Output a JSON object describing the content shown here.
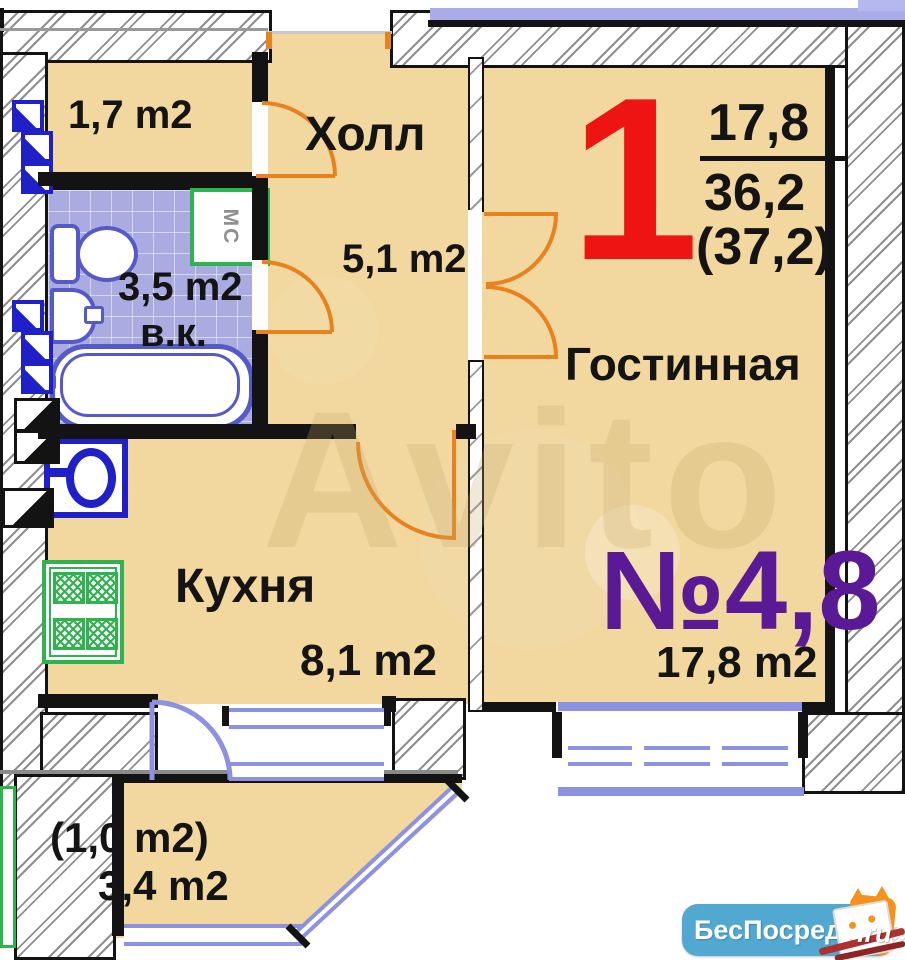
{
  "labels": {
    "closet_area": "1,7 m2",
    "hall_name": "Холл",
    "hall_area": "5,1 m2",
    "bath_area": "3,5 m2",
    "bath_abbr": "в.к.",
    "mc": "МС",
    "unit_number": "1",
    "living_area_top": "17,8",
    "total_area": "36,2",
    "total_area_paren": "(37,2)",
    "living_name": "Гостинная",
    "living_no": "№4,8",
    "living_area": "17,8 m2",
    "kitchen_name": "Кухня",
    "kitchen_area": "8,1 m2",
    "balcony_paren": "(1,0 m2)",
    "balcony_area": "3,4 m2"
  },
  "watermark": {
    "text": "Avito"
  },
  "logo": {
    "text": "БесПосредника",
    "suffix": ".ru"
  },
  "colors": {
    "room_fill": "#f2d89e",
    "bathroom_tile": "#aaace1",
    "wall": "#131313",
    "door_arc": "#e8821e",
    "window_frame": "#8c91e1",
    "unit_number_red": "#ee1414",
    "flat_number_purple": "#5a1a96",
    "stove_green": "#2eb34e",
    "fixture_blue": "#555ac8",
    "logo_bg": "#51a8d0"
  }
}
